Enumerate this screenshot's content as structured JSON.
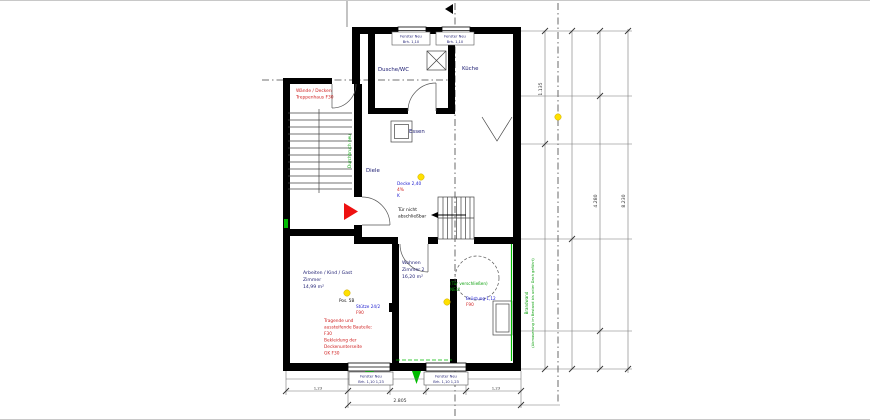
{
  "floor_plan": {
    "rooms": {
      "dusche_wc": "Dusche/WC",
      "kueche": "Küche",
      "essen": "Essen",
      "diele": "Diele",
      "arbeiten": {
        "l1": "Arbeiten / Kind / Gast",
        "l2": "Zimmer",
        "area": "14,99 m²"
      },
      "wohnen": {
        "l1": "Wohnen",
        "l2": "Zimmer 2",
        "area": "16,20 m²"
      }
    },
    "windows": {
      "top1": {
        "l1": "Fenster Neu",
        "l2": "Brh. 1,10"
      },
      "top2": {
        "l1": "Fenster Neu",
        "l2": "Brh. 1,10"
      },
      "bottom1": {
        "l1": "Fenster Neu",
        "l2": "Brh. 1,10  1,23"
      },
      "bottom2": {
        "l1": "Fenster Neu",
        "l2": "Brh. 1,10  1,23"
      }
    },
    "annotations": {
      "stair_fire": {
        "l1": "Wände / Decken",
        "l2": "Treppenhaus F30"
      },
      "door_note": {
        "l1": "Tür nicht",
        "l2": "abschließbar"
      },
      "ceiling": {
        "blue": "Decke 2,40",
        "red": "4%",
        "blue2": "K"
      },
      "column": {
        "black": "Pos. 5B",
        "blue": "Stütze 24/2",
        "red": "F90"
      },
      "green_door": {
        "l1": "(Tür verschließen)",
        "l2": "NEU!"
      },
      "sill": {
        "blue": "Brüstung 1,12",
        "red": "F90"
      },
      "brandwand": {
        "l1": "Brandwand",
        "l2": "(Abmauerung im Bestand bis unter Dach geführt)"
      },
      "durchbruch": "Durchbruch neu",
      "fire_lines": [
        "Tragende und",
        "aussteifende Bauteile:",
        "F30",
        "Bekleidung der",
        "Deckenunterseite",
        "GK F30"
      ]
    },
    "dimensions": {
      "right_upper": "1.135",
      "right_main": "4.280",
      "right_total": "8.230",
      "bottom_total": "2.805",
      "bottom_win1": "1,23",
      "bottom_win2": "1,23"
    },
    "colors": {
      "wall": "#000000",
      "new_green": "#00bb00",
      "demolition_red": "#ee1111",
      "marker_yellow": "#ffe000",
      "annotation_blue": "#2020d0"
    }
  }
}
